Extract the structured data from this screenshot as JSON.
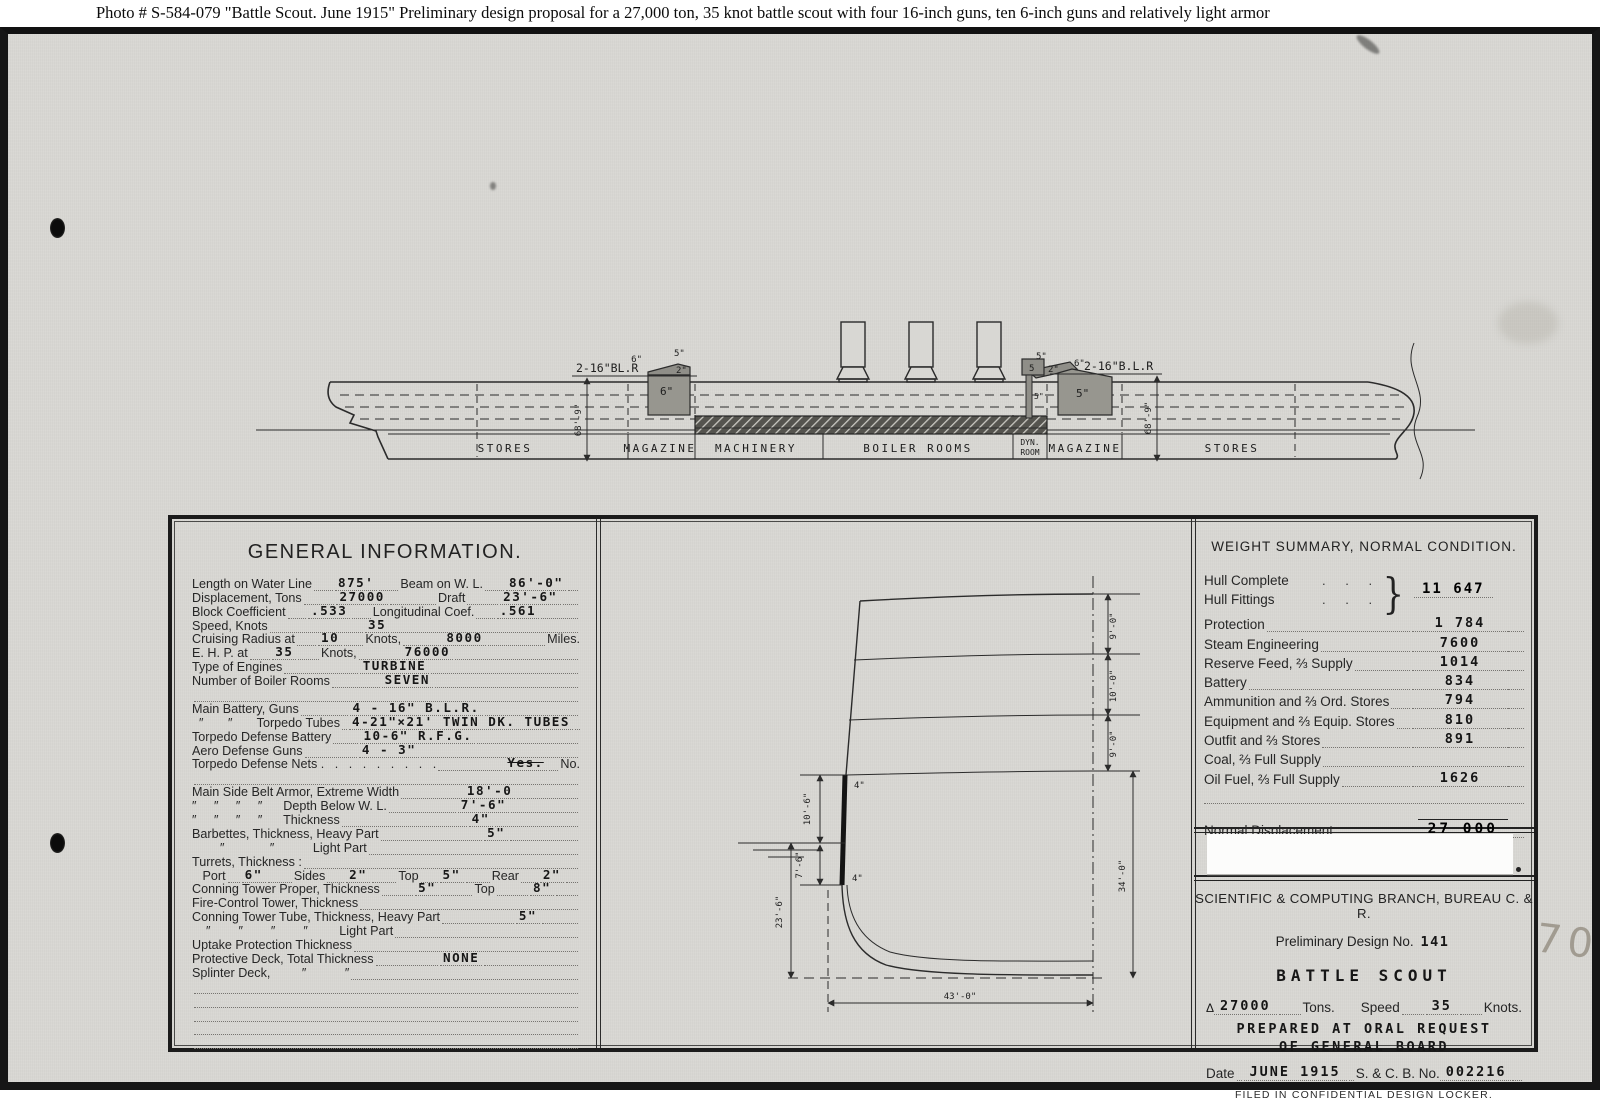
{
  "caption": "Photo #  S-584-079    \"Battle Scout.  June 1915\"   Preliminary design proposal for a 27,000 ton, 35 knot battle scout with four 16-inch guns, ten 6-inch guns and relatively light armor",
  "pencil_note": "70",
  "profile": {
    "aft_gun_label": "2-16\"BL.R",
    "fwd_gun_prefix": "6\"",
    "fwd_gun_label": "2-16\"B.L.R",
    "aft_cap_6": "6\"",
    "aft_cap_5": "5\"",
    "aft_cap_2": "2\"",
    "aft_face": "6\"",
    "fwd_cap_5": "5\"",
    "fwd_cap_2": "2\"",
    "fwd_face": "5\"",
    "ct_top": "5",
    "ct_tube": "5\"",
    "dim_aft": "68'-9\"",
    "dim_fwd": "68'-9\"",
    "compartments": [
      "STORES",
      "MAGAZINE",
      "MACHINERY",
      "BOILER ROOMS",
      "DYN.",
      "ROOM",
      "MAGAZINE",
      "STORES"
    ]
  },
  "general_info": {
    "title": "GENERAL INFORMATION.",
    "lines": [
      {
        "parts": [
          {
            "t": "l",
            "s": "Length on Water Line"
          },
          {
            "t": "g",
            "f": 2
          },
          {
            "t": "v",
            "s": "875'"
          },
          {
            "t": "g",
            "f": 2
          },
          {
            "t": "l",
            "s": "Beam on W. L."
          },
          {
            "t": "g",
            "f": 2
          },
          {
            "t": "v",
            "s": "86'-0\""
          },
          {
            "t": "g",
            "f": 1
          }
        ]
      },
      {
        "parts": [
          {
            "t": "l",
            "s": "Displacement, Tons"
          },
          {
            "t": "g",
            "f": 2
          },
          {
            "t": "v",
            "s": "27000"
          },
          {
            "t": "g",
            "f": 3
          },
          {
            "t": "l",
            "s": "Draft"
          },
          {
            "t": "g",
            "f": 2
          },
          {
            "t": "v",
            "s": "23'-6\""
          },
          {
            "t": "g",
            "f": 1
          }
        ]
      },
      {
        "parts": [
          {
            "t": "l",
            "s": "Block Coefficient"
          },
          {
            "t": "g",
            "f": 1
          },
          {
            "t": "v",
            "s": ".533"
          },
          {
            "t": "g",
            "f": 1
          },
          {
            "t": "l",
            "s": "Longitudinal Coef."
          },
          {
            "t": "g",
            "f": 1
          },
          {
            "t": "v",
            "s": ".561"
          },
          {
            "t": "g",
            "f": 2
          }
        ]
      },
      {
        "parts": [
          {
            "t": "l",
            "s": "Speed, Knots"
          },
          {
            "t": "g",
            "f": 4
          },
          {
            "t": "v",
            "s": "35"
          },
          {
            "t": "g",
            "f": 8
          }
        ]
      },
      {
        "parts": [
          {
            "t": "l",
            "s": "Cruising Radius at"
          },
          {
            "t": "g",
            "f": 1
          },
          {
            "t": "v",
            "s": "10"
          },
          {
            "t": "g",
            "f": 1
          },
          {
            "t": "l",
            "s": "Knots,"
          },
          {
            "t": "g",
            "f": 2
          },
          {
            "t": "v",
            "s": "8000"
          },
          {
            "t": "g",
            "f": 3
          },
          {
            "t": "l",
            "s": "Miles."
          }
        ]
      },
      {
        "parts": [
          {
            "t": "l",
            "s": "E. H. P. at"
          },
          {
            "t": "g",
            "f": 1
          },
          {
            "t": "v",
            "s": "35"
          },
          {
            "t": "g",
            "f": 1
          },
          {
            "t": "l",
            "s": "Knots,"
          },
          {
            "t": "g",
            "f": 2
          },
          {
            "t": "v",
            "s": "76000"
          },
          {
            "t": "g",
            "f": 6
          }
        ]
      },
      {
        "parts": [
          {
            "t": "l",
            "s": "Type of Engines"
          },
          {
            "t": "g",
            "f": 3
          },
          {
            "t": "v",
            "s": "TURBINE"
          },
          {
            "t": "g",
            "f": 6
          }
        ]
      },
      {
        "parts": [
          {
            "t": "l",
            "s": "Number of Boiler Rooms"
          },
          {
            "t": "g",
            "f": 2
          },
          {
            "t": "v",
            "s": "SEVEN"
          },
          {
            "t": "g",
            "f": 6
          }
        ]
      },
      {
        "parts": [
          {
            "t": "g",
            "f": 1
          }
        ]
      },
      {
        "parts": [
          {
            "t": "l",
            "s": "Main Battery, Guns"
          },
          {
            "t": "g",
            "f": 2
          },
          {
            "t": "v",
            "s": "4 - 16\" B.L.R."
          },
          {
            "t": "g",
            "f": 4
          }
        ]
      },
      {
        "parts": [
          {
            "t": "l",
            "s": "  ″       ″       Torpedo Tubes"
          },
          {
            "t": "g",
            "f": 0.3
          },
          {
            "t": "v",
            "s": "4-21\"×21' TWIN DK. TUBES"
          },
          {
            "t": "g",
            "f": 0.5
          }
        ]
      },
      {
        "parts": [
          {
            "t": "l",
            "s": "Torpedo Defense Battery"
          },
          {
            "t": "g",
            "f": 1
          },
          {
            "t": "v",
            "s": "10-6\" R.F.G."
          },
          {
            "t": "g",
            "f": 4
          }
        ]
      },
      {
        "parts": [
          {
            "t": "l",
            "s": "Aero Defense Guns"
          },
          {
            "t": "g",
            "f": 2
          },
          {
            "t": "v",
            "s": "4 - 3\""
          },
          {
            "t": "g",
            "f": 6
          }
        ]
      },
      {
        "parts": [
          {
            "t": "l",
            "s": "Torpedo Defense Nets .   .   .   .   .   .   .   .   ."
          },
          {
            "t": "g",
            "f": 2
          },
          {
            "t": "x",
            "s": "Yes."
          },
          {
            "t": "g",
            "f": 0.3
          },
          {
            "t": "l",
            "s": "No."
          }
        ]
      },
      {
        "parts": [
          {
            "t": "g",
            "f": 1
          }
        ]
      },
      {
        "parts": [
          {
            "t": "l",
            "s": "Main Side Belt Armor, Extreme Width"
          },
          {
            "t": "g",
            "f": 2
          },
          {
            "t": "v",
            "s": "18'-0"
          },
          {
            "t": "g",
            "f": 2
          }
        ]
      },
      {
        "parts": [
          {
            "t": "l",
            "s": "″     ″     ″     ″      Depth Below W. L."
          },
          {
            "t": "g",
            "f": 2
          },
          {
            "t": "v",
            "s": "7'-6\""
          },
          {
            "t": "g",
            "f": 2
          }
        ]
      },
      {
        "parts": [
          {
            "t": "l",
            "s": "″     ″     ″     ″      Thickness"
          },
          {
            "t": "g",
            "f": 3
          },
          {
            "t": "v",
            "s": "4\""
          },
          {
            "t": "g",
            "f": 2
          }
        ]
      },
      {
        "parts": [
          {
            "t": "l",
            "s": "Barbettes, Thickness, Heavy Part"
          },
          {
            "t": "g",
            "f": 3
          },
          {
            "t": "v",
            "s": "5\""
          },
          {
            "t": "g",
            "f": 2
          }
        ]
      },
      {
        "parts": [
          {
            "t": "l",
            "s": "        ″             ″           Light Part"
          },
          {
            "t": "g",
            "f": 4
          }
        ]
      },
      {
        "parts": [
          {
            "t": "l",
            "s": "Turrets, Thickness :"
          },
          {
            "t": "g",
            "f": 6
          }
        ]
      },
      {
        "parts": [
          {
            "t": "l",
            "s": "   Port"
          },
          {
            "t": "g",
            "f": 0.5
          },
          {
            "t": "v",
            "s": "6\""
          },
          {
            "t": "g",
            "f": 1
          },
          {
            "t": "l",
            "s": "Sides"
          },
          {
            "t": "g",
            "f": 0.7
          },
          {
            "t": "v",
            "s": "2\""
          },
          {
            "t": "g",
            "f": 1
          },
          {
            "t": "l",
            "s": "Top"
          },
          {
            "t": "g",
            "f": 0.7
          },
          {
            "t": "v",
            "s": "5\""
          },
          {
            "t": "g",
            "f": 1
          },
          {
            "t": "l",
            "s": "Rear"
          },
          {
            "t": "g",
            "f": 0.7
          },
          {
            "t": "v",
            "s": "2\""
          },
          {
            "t": "g",
            "f": 0.5
          }
        ]
      },
      {
        "parts": [
          {
            "t": "l",
            "s": "Conning Tower Proper, Thickness"
          },
          {
            "t": "g",
            "f": 1
          },
          {
            "t": "v",
            "s": "5\""
          },
          {
            "t": "g",
            "f": 1
          },
          {
            "t": "l",
            "s": "Top"
          },
          {
            "t": "g",
            "f": 1
          },
          {
            "t": "v",
            "s": "8\""
          },
          {
            "t": "g",
            "f": 0.7
          }
        ]
      },
      {
        "parts": [
          {
            "t": "l",
            "s": "Fire-Control Tower, Thickness"
          },
          {
            "t": "g",
            "f": 5
          }
        ]
      },
      {
        "parts": [
          {
            "t": "l",
            "s": "Conning Tower Tube, Thickness, Heavy Part"
          },
          {
            "t": "g",
            "f": 2
          },
          {
            "t": "v",
            "s": "5\""
          },
          {
            "t": "g",
            "f": 1
          }
        ]
      },
      {
        "parts": [
          {
            "t": "l",
            "s": "    ″        ″        ″        ″         Light Part"
          },
          {
            "t": "g",
            "f": 4
          }
        ]
      },
      {
        "parts": [
          {
            "t": "l",
            "s": "Uptake Protection Thickness"
          },
          {
            "t": "g",
            "f": 5
          }
        ]
      },
      {
        "parts": [
          {
            "t": "l",
            "s": "Protective Deck, Total Thickness"
          },
          {
            "t": "g",
            "f": 2
          },
          {
            "t": "v",
            "s": "NONE"
          },
          {
            "t": "g",
            "f": 3
          }
        ]
      },
      {
        "parts": [
          {
            "t": "l",
            "s": "Splinter Deck,         ″           ″"
          },
          {
            "t": "g",
            "f": 4
          }
        ]
      },
      {
        "parts": [
          {
            "t": "g",
            "f": 1
          }
        ]
      },
      {
        "parts": [
          {
            "t": "g",
            "f": 1
          }
        ]
      },
      {
        "parts": [
          {
            "t": "g",
            "f": 1
          }
        ]
      },
      {
        "parts": [
          {
            "t": "g",
            "f": 1
          }
        ]
      },
      {
        "parts": [
          {
            "t": "g",
            "f": 1
          }
        ]
      }
    ]
  },
  "weight_summary": {
    "title": "WEIGHT SUMMARY, NORMAL CONDITION.",
    "hull_complete_label": "Hull Complete",
    "hull_fittings_label": "Hull Fittings",
    "hull_dots": ".    .    .",
    "hull_brace": "}",
    "hull_value": "11 647",
    "rows": [
      {
        "label": "Protection",
        "value": "1 784"
      },
      {
        "label": "Steam Engineering",
        "value": "7600"
      },
      {
        "label": "Reserve Feed, ⅔ Supply",
        "value": "1014"
      },
      {
        "label": "Battery",
        "value": "834"
      },
      {
        "label": "Ammunition and ⅔ Ord. Stores",
        "value": "794"
      },
      {
        "label": "Equipment and ⅔ Equip. Stores",
        "value": "810"
      },
      {
        "label": "Outfit and ⅔ Stores",
        "value": "891"
      },
      {
        "label": "Coal, ⅔ Full Supply",
        "value": ""
      },
      {
        "label": "Oil Fuel, ⅔ Full Supply",
        "value": "1626"
      }
    ],
    "total_label": "Normal Displacement",
    "total_value": "27 000"
  },
  "title_block": {
    "branch": "SCIENTIFIC & COMPUTING BRANCH, BUREAU C. & R.",
    "design_no_label": "Preliminary Design No.",
    "design_no": "141",
    "ship_type": "BATTLE SCOUT",
    "displacement_symbol": "Δ",
    "tons_value": "27000",
    "tons_label": "Tons.",
    "speed_label": "Speed",
    "speed_value": "35",
    "knots_label": "Knots.",
    "prepared_1": "PREPARED AT ORAL REQUEST",
    "prepared_2": "OF GENERAL BOARD",
    "date_label": "Date",
    "date_value": "JUNE 1915",
    "scb_label": "S. & C. B. No.",
    "scb_value": "002216",
    "filed": "FILED IN CONFIDENTIAL DESIGN LOCKER."
  },
  "section_dims": {
    "d_9a": "9'-0\"",
    "d_10": "10'-0\"",
    "d_9b": "9'-0\"",
    "d_34": "34'-0\"",
    "d_43": "43'-0\"",
    "d_106": "10'-6\"",
    "d_76": "7'-6\"",
    "d_236": "23'-6\"",
    "belt_top": "4\"",
    "belt_bot": "4\""
  }
}
